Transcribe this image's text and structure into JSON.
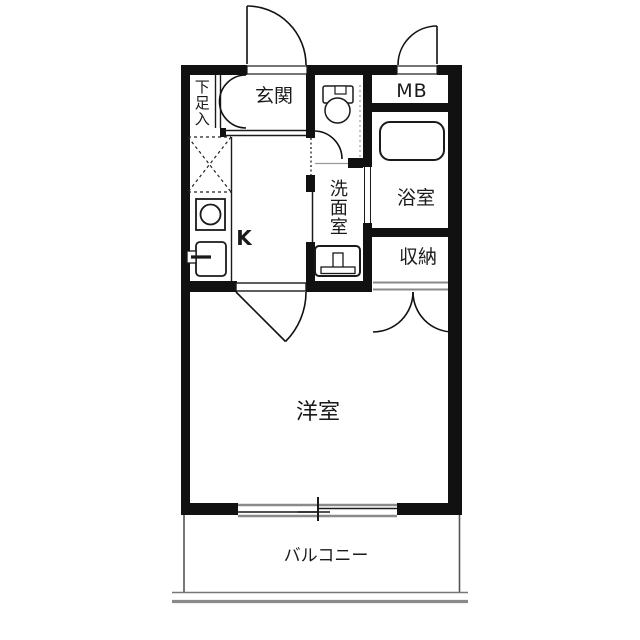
{
  "labels": {
    "shoe_storage": "下足入",
    "entrance": "玄関",
    "meter_box": "MB",
    "washroom": "洗面室",
    "bathroom": "浴室",
    "storage": "収納",
    "kitchen": "K",
    "western_room": "洋室",
    "balcony": "バルコニー"
  },
  "fixtures": {
    "toilet": "toilet-icon",
    "bathtub": "bathtub-icon",
    "washbasin": "washbasin-icon",
    "stove": "stove-icon",
    "sink": "sink-icon",
    "refrigerator_space": "dashed-x-box"
  },
  "colors": {
    "wall": "#111111",
    "line": "#1a1a1a",
    "gray_line": "#8a8a8a",
    "background": "#ffffff"
  }
}
